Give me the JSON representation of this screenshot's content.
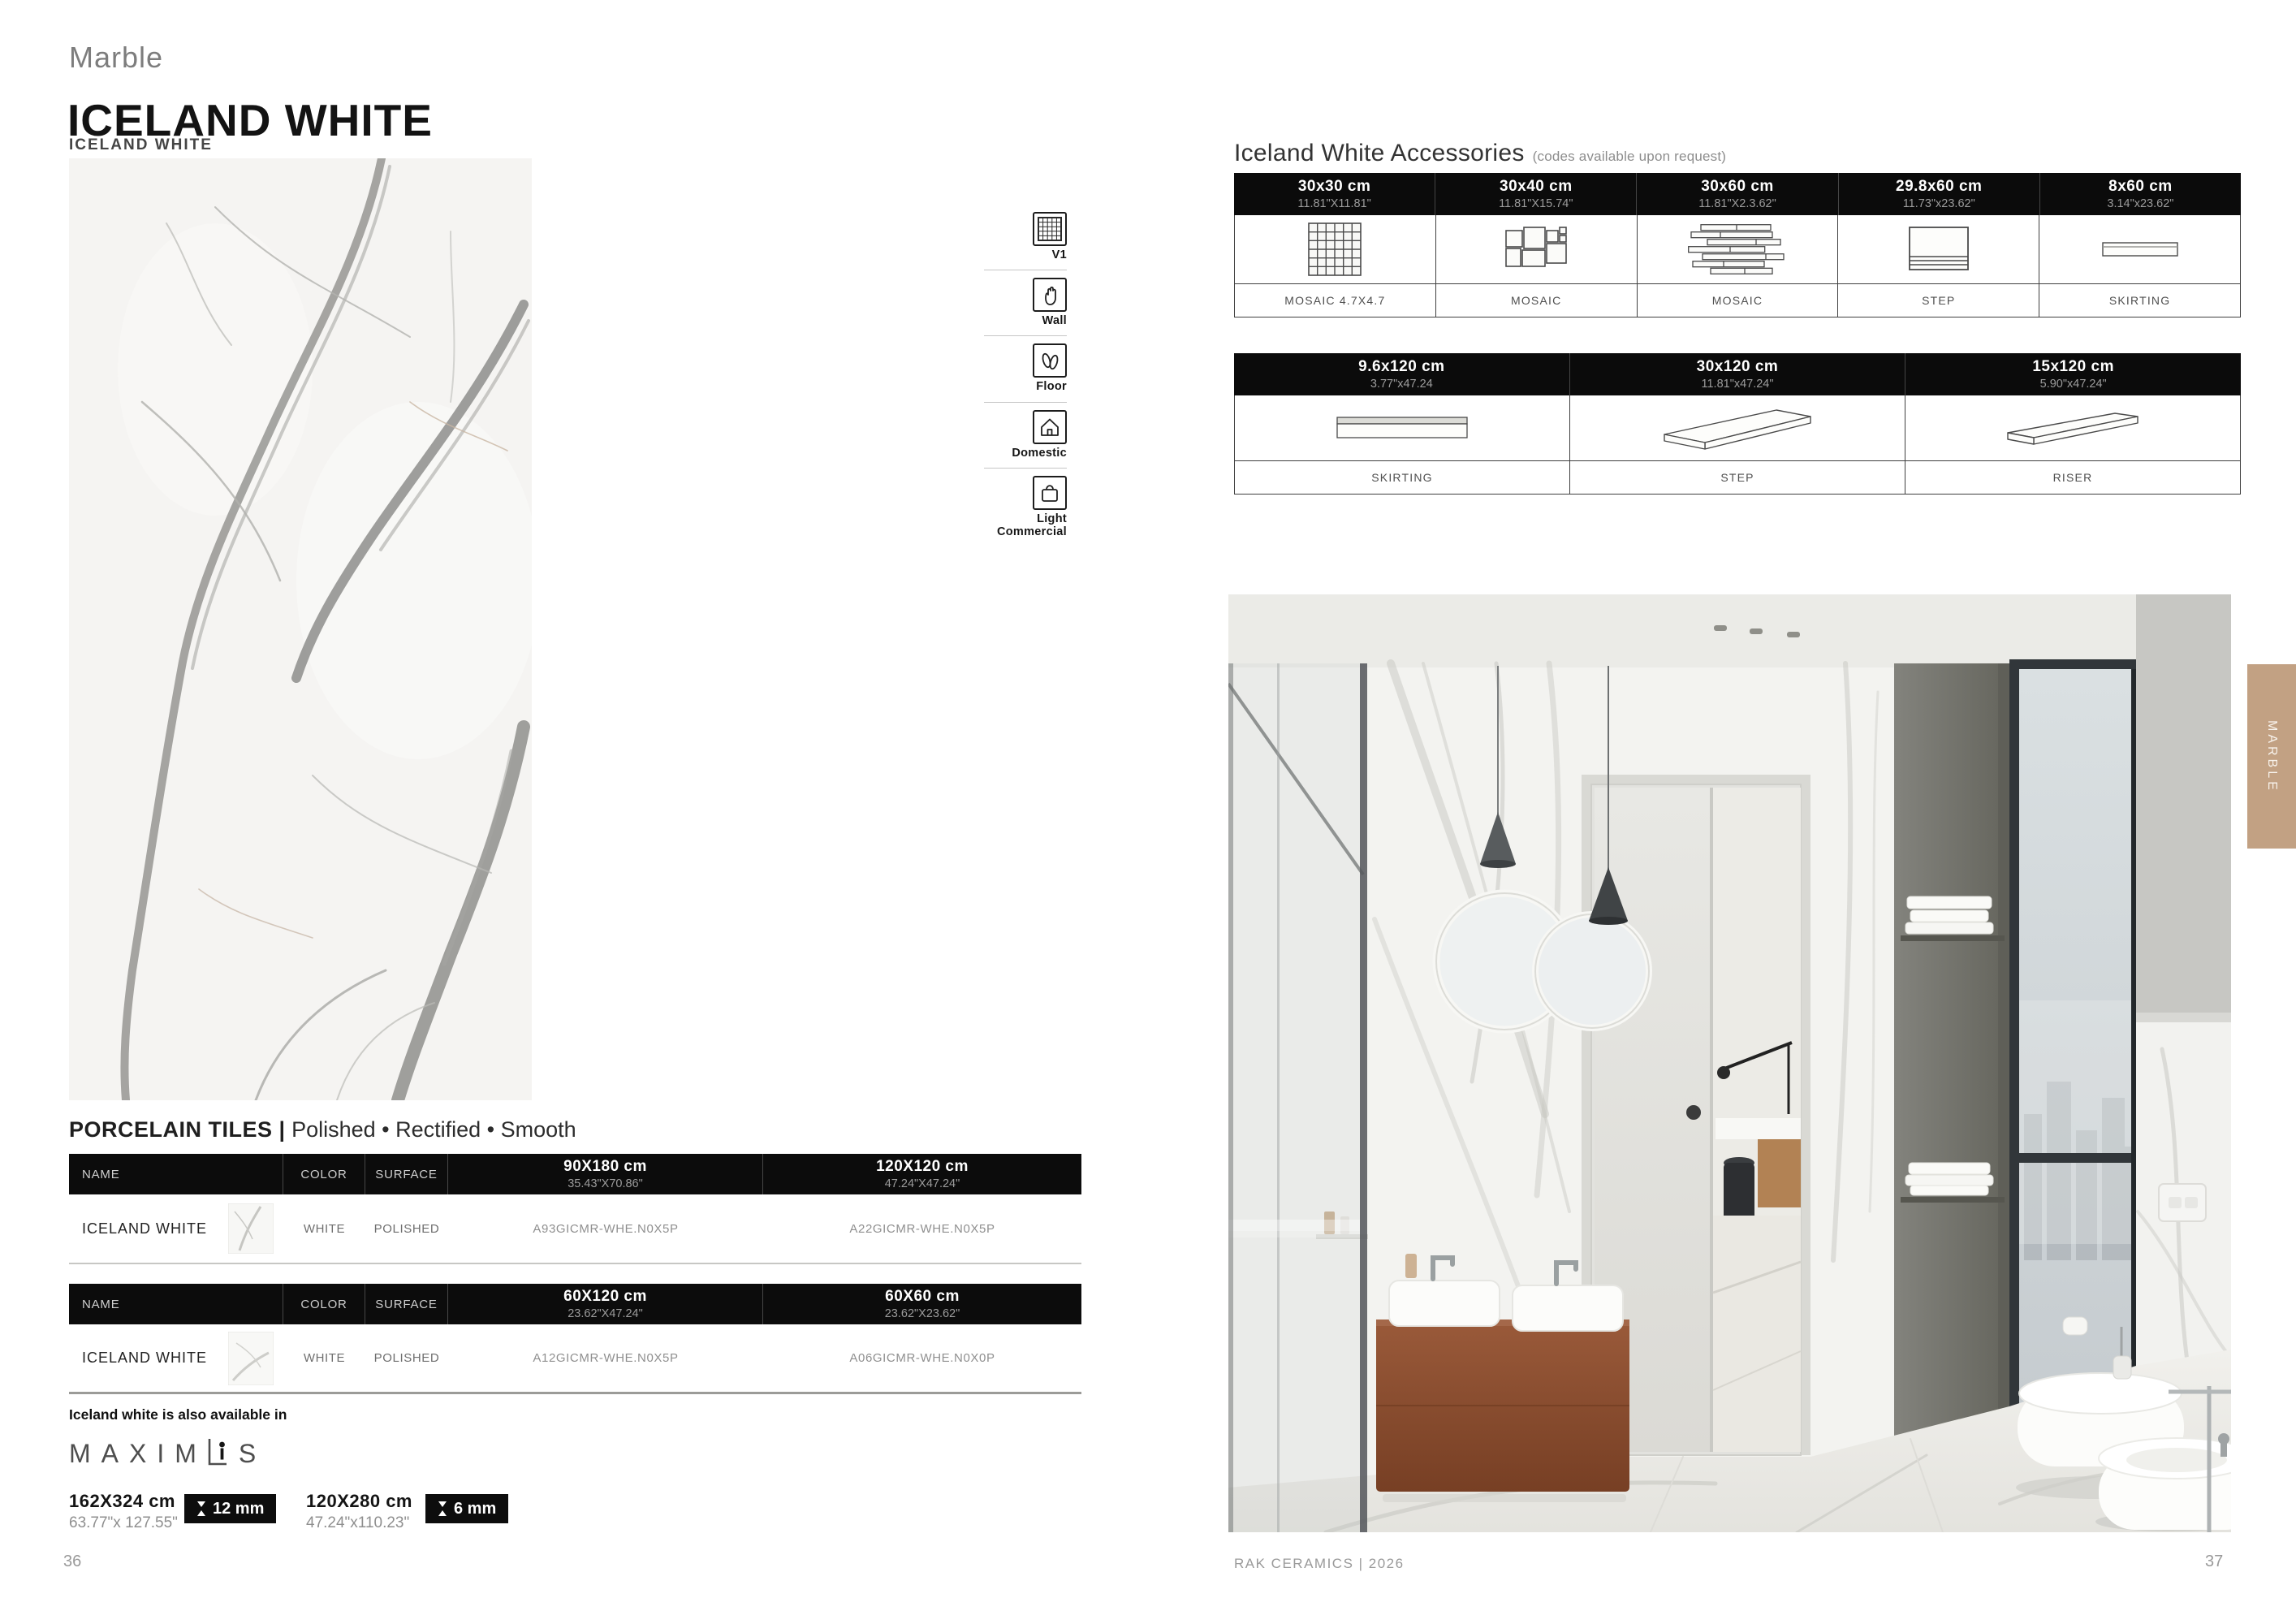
{
  "page": {
    "category_label": "Marble",
    "title": "ICELAND WHITE",
    "image_caption": "ICELAND WHITE",
    "side_tab": "MARBLE",
    "footer_brand": "RAK CERAMICS | 2026",
    "page_number_left": "36",
    "page_number_right": "37"
  },
  "usage_icons": [
    {
      "label": "V1",
      "icon": "grid-icon"
    },
    {
      "label": "Wall",
      "icon": "hand-icon"
    },
    {
      "label": "Floor",
      "icon": "footprints-icon"
    },
    {
      "label": "Domestic",
      "icon": "house-icon"
    },
    {
      "label": "Light Commercial",
      "icon": "shopping-bag-icon"
    }
  ],
  "tiles": {
    "heading_bold": "PORCELAIN TILES |",
    "heading_rest": " Polished • Rectified • Smooth",
    "headers": {
      "name": "NAME",
      "color": "COLOR",
      "surface": "SURFACE"
    },
    "table1": {
      "size1": {
        "cm": "90X180 cm",
        "inch": "35.43\"X70.86\""
      },
      "size2": {
        "cm": "120X120 cm",
        "inch": "47.24\"X47.24\""
      },
      "row": {
        "name": "ICELAND WHITE",
        "color": "WHITE",
        "surface": "POLISHED",
        "code1": "A93GICMR-WHE.N0X5P",
        "code2": "A22GICMR-WHE.N0X5P"
      }
    },
    "table2": {
      "size1": {
        "cm": "60X120 cm",
        "inch": "23.62\"X47.24\""
      },
      "size2": {
        "cm": "60X60 cm",
        "inch": "23.62\"X23.62\""
      },
      "row": {
        "name": "ICELAND WHITE",
        "color": "WHITE",
        "surface": "POLISHED",
        "code1": "A12GICMR-WHE.N0X5P",
        "code2": "A06GICMR-WHE.N0X0P"
      }
    },
    "also_available": "Iceland white is also available in",
    "maximus_left": "MAXIM",
    "maximus_right": "S",
    "slab_sizes": [
      {
        "cm": "162X324 cm",
        "inch": "63.77\"x 127.55\"",
        "thickness": "12 mm"
      },
      {
        "cm": "120X280 cm",
        "inch": "47.24\"x110.23\"",
        "thickness": "6 mm"
      }
    ]
  },
  "accessories": {
    "title": "Iceland White Accessories",
    "note": "(codes available upon request)",
    "row1": [
      {
        "size": "30x30 cm",
        "inch": "11.81\"X11.81\"",
        "label": "MOSAIC 4.7X4.7",
        "icon": "mosaic-grid-icon"
      },
      {
        "size": "30x40 cm",
        "inch": "11.81\"X15.74\"",
        "label": "MOSAIC",
        "icon": "mosaic-modular-icon"
      },
      {
        "size": "30x60 cm",
        "inch": "11.81\"X2.3.62\"",
        "label": "MOSAIC",
        "icon": "mosaic-strips-icon"
      },
      {
        "size": "29.8x60 cm",
        "inch": "11.73\"x23.62\"",
        "label": "STEP",
        "icon": "step-icon"
      },
      {
        "size": "8x60 cm",
        "inch": "3.14\"x23.62\"",
        "label": "SKIRTING",
        "icon": "skirting-icon"
      }
    ],
    "row2": [
      {
        "size": "9.6x120 cm",
        "inch": "3.77\"x47.24",
        "label": "SKIRTING",
        "icon": "skirting-long-icon"
      },
      {
        "size": "30x120 cm",
        "inch": "11.81\"x47.24\"",
        "label": "STEP",
        "icon": "step-3d-icon"
      },
      {
        "size": "15x120 cm",
        "inch": "5.90\"x47.24\"",
        "label": "RISER",
        "icon": "riser-3d-icon"
      }
    ]
  }
}
